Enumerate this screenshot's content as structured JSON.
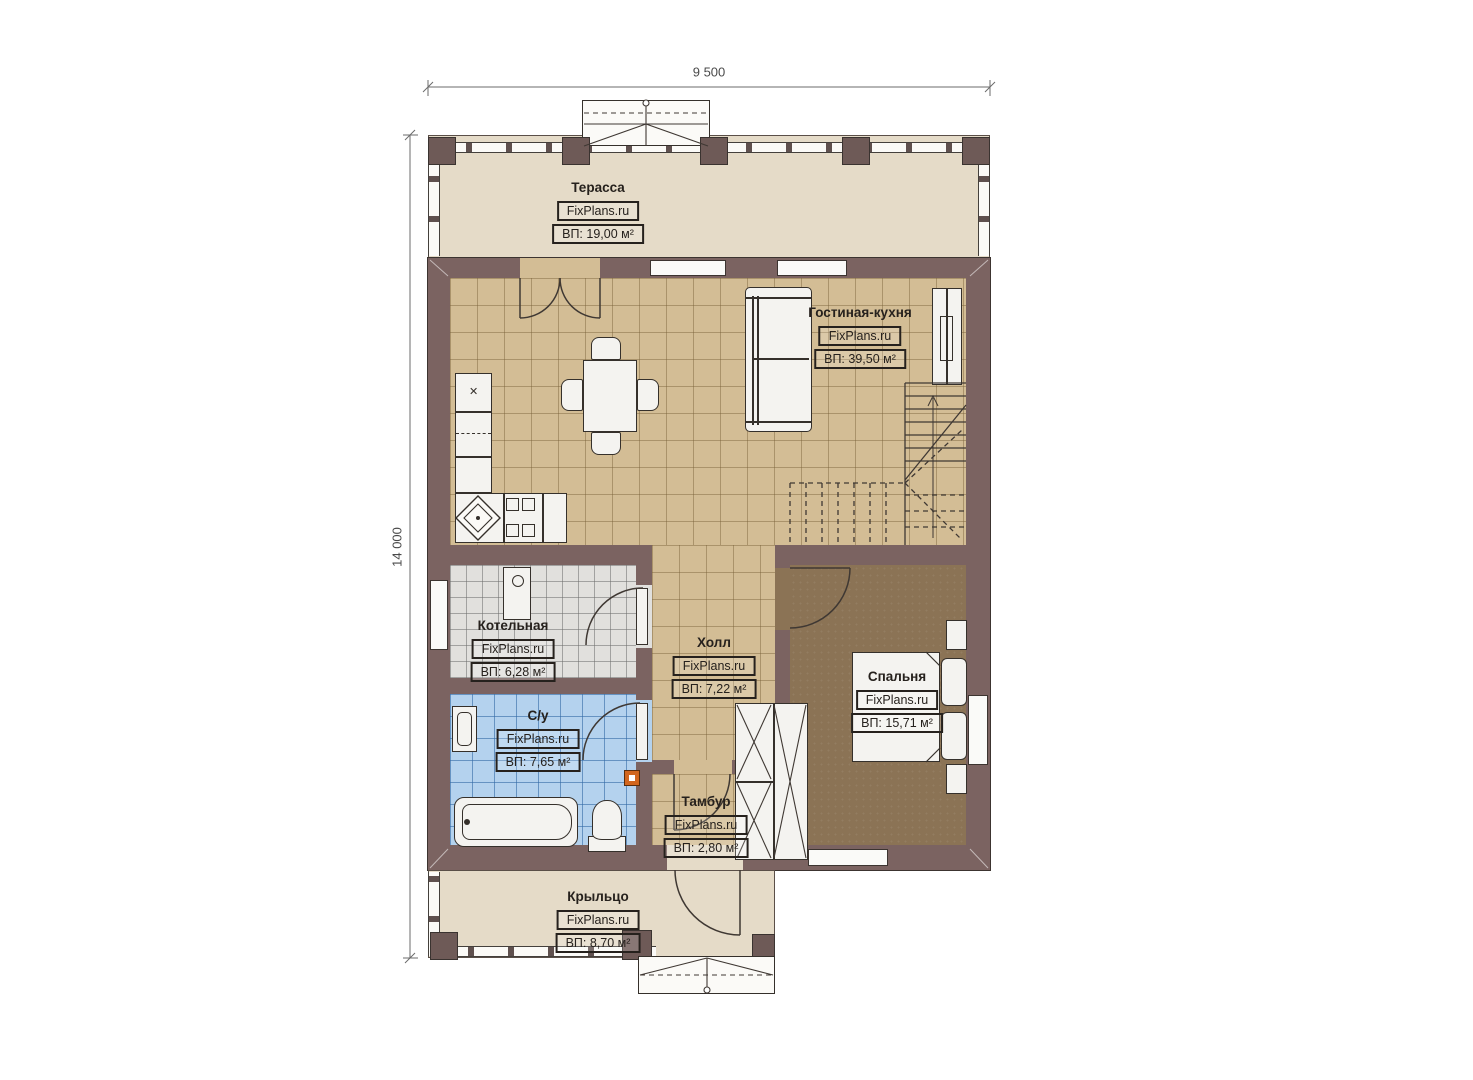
{
  "watermark": "FixPlans.ru",
  "plan": {
    "type": "floor-plan",
    "dimensions": {
      "width": "9 500",
      "height": "14 000"
    }
  },
  "rooms": [
    {
      "key": "terrace",
      "name": "Терасса",
      "area": "ВП: 19,00 м²"
    },
    {
      "key": "living-kitchen",
      "name": "Гостиная-кухня",
      "area": "ВП: 39,50 м²"
    },
    {
      "key": "boiler-room",
      "name": "Котельная",
      "area": "ВП: 6,28 м²"
    },
    {
      "key": "hall",
      "name": "Холл",
      "area": "ВП: 7,22 м²"
    },
    {
      "key": "bathroom",
      "name": "С/у",
      "area": "ВП: 7,65 м²"
    },
    {
      "key": "bedroom",
      "name": "Спальня",
      "area": "ВП: 15,71 м²"
    },
    {
      "key": "vestibule",
      "name": "Тамбур",
      "area": "ВП: 2,80 м²"
    },
    {
      "key": "porch",
      "name": "Крыльцо",
      "area": "ВП: 8,70 м²"
    }
  ],
  "colors": {
    "wall": "#7b6361",
    "terrace_floor": "#e5dbc8",
    "tile_floor": "#d3bd95",
    "boiler_floor": "#e1e0dd",
    "bath_floor": "#b4d2ee",
    "bedroom_floor": "#8b7355",
    "accent_electro_box": "#d2661e",
    "linework": "#35302b"
  }
}
